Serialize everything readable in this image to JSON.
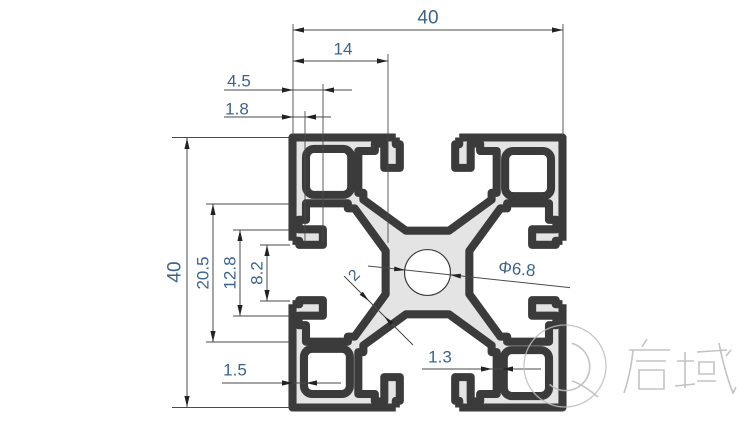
{
  "page": {
    "background": "#ffffff",
    "kind": "engineering-drawing",
    "subject": "4040 aluminium extrusion profile cross-section"
  },
  "colors": {
    "profile_fill": "#e4e4e4",
    "line": "#3b3b3b",
    "dim_line": "#4a4a4a",
    "dim_text": "#3a648f",
    "watermark": "#bcbcbc"
  },
  "dimensions": {
    "top_width": "40",
    "slot_position": "14",
    "lip_depth": "4.5",
    "lip_thickness": "1.8",
    "side_height": "40",
    "cavity_span": "20.5",
    "wing_width": "12.8",
    "slot_opening": "8.2",
    "outer_wall": "1.5",
    "inner_wall": "1.3",
    "center_hole_diameter": "Φ6.8",
    "web_thickness": "2"
  },
  "watermark": {
    "text": "启域"
  }
}
